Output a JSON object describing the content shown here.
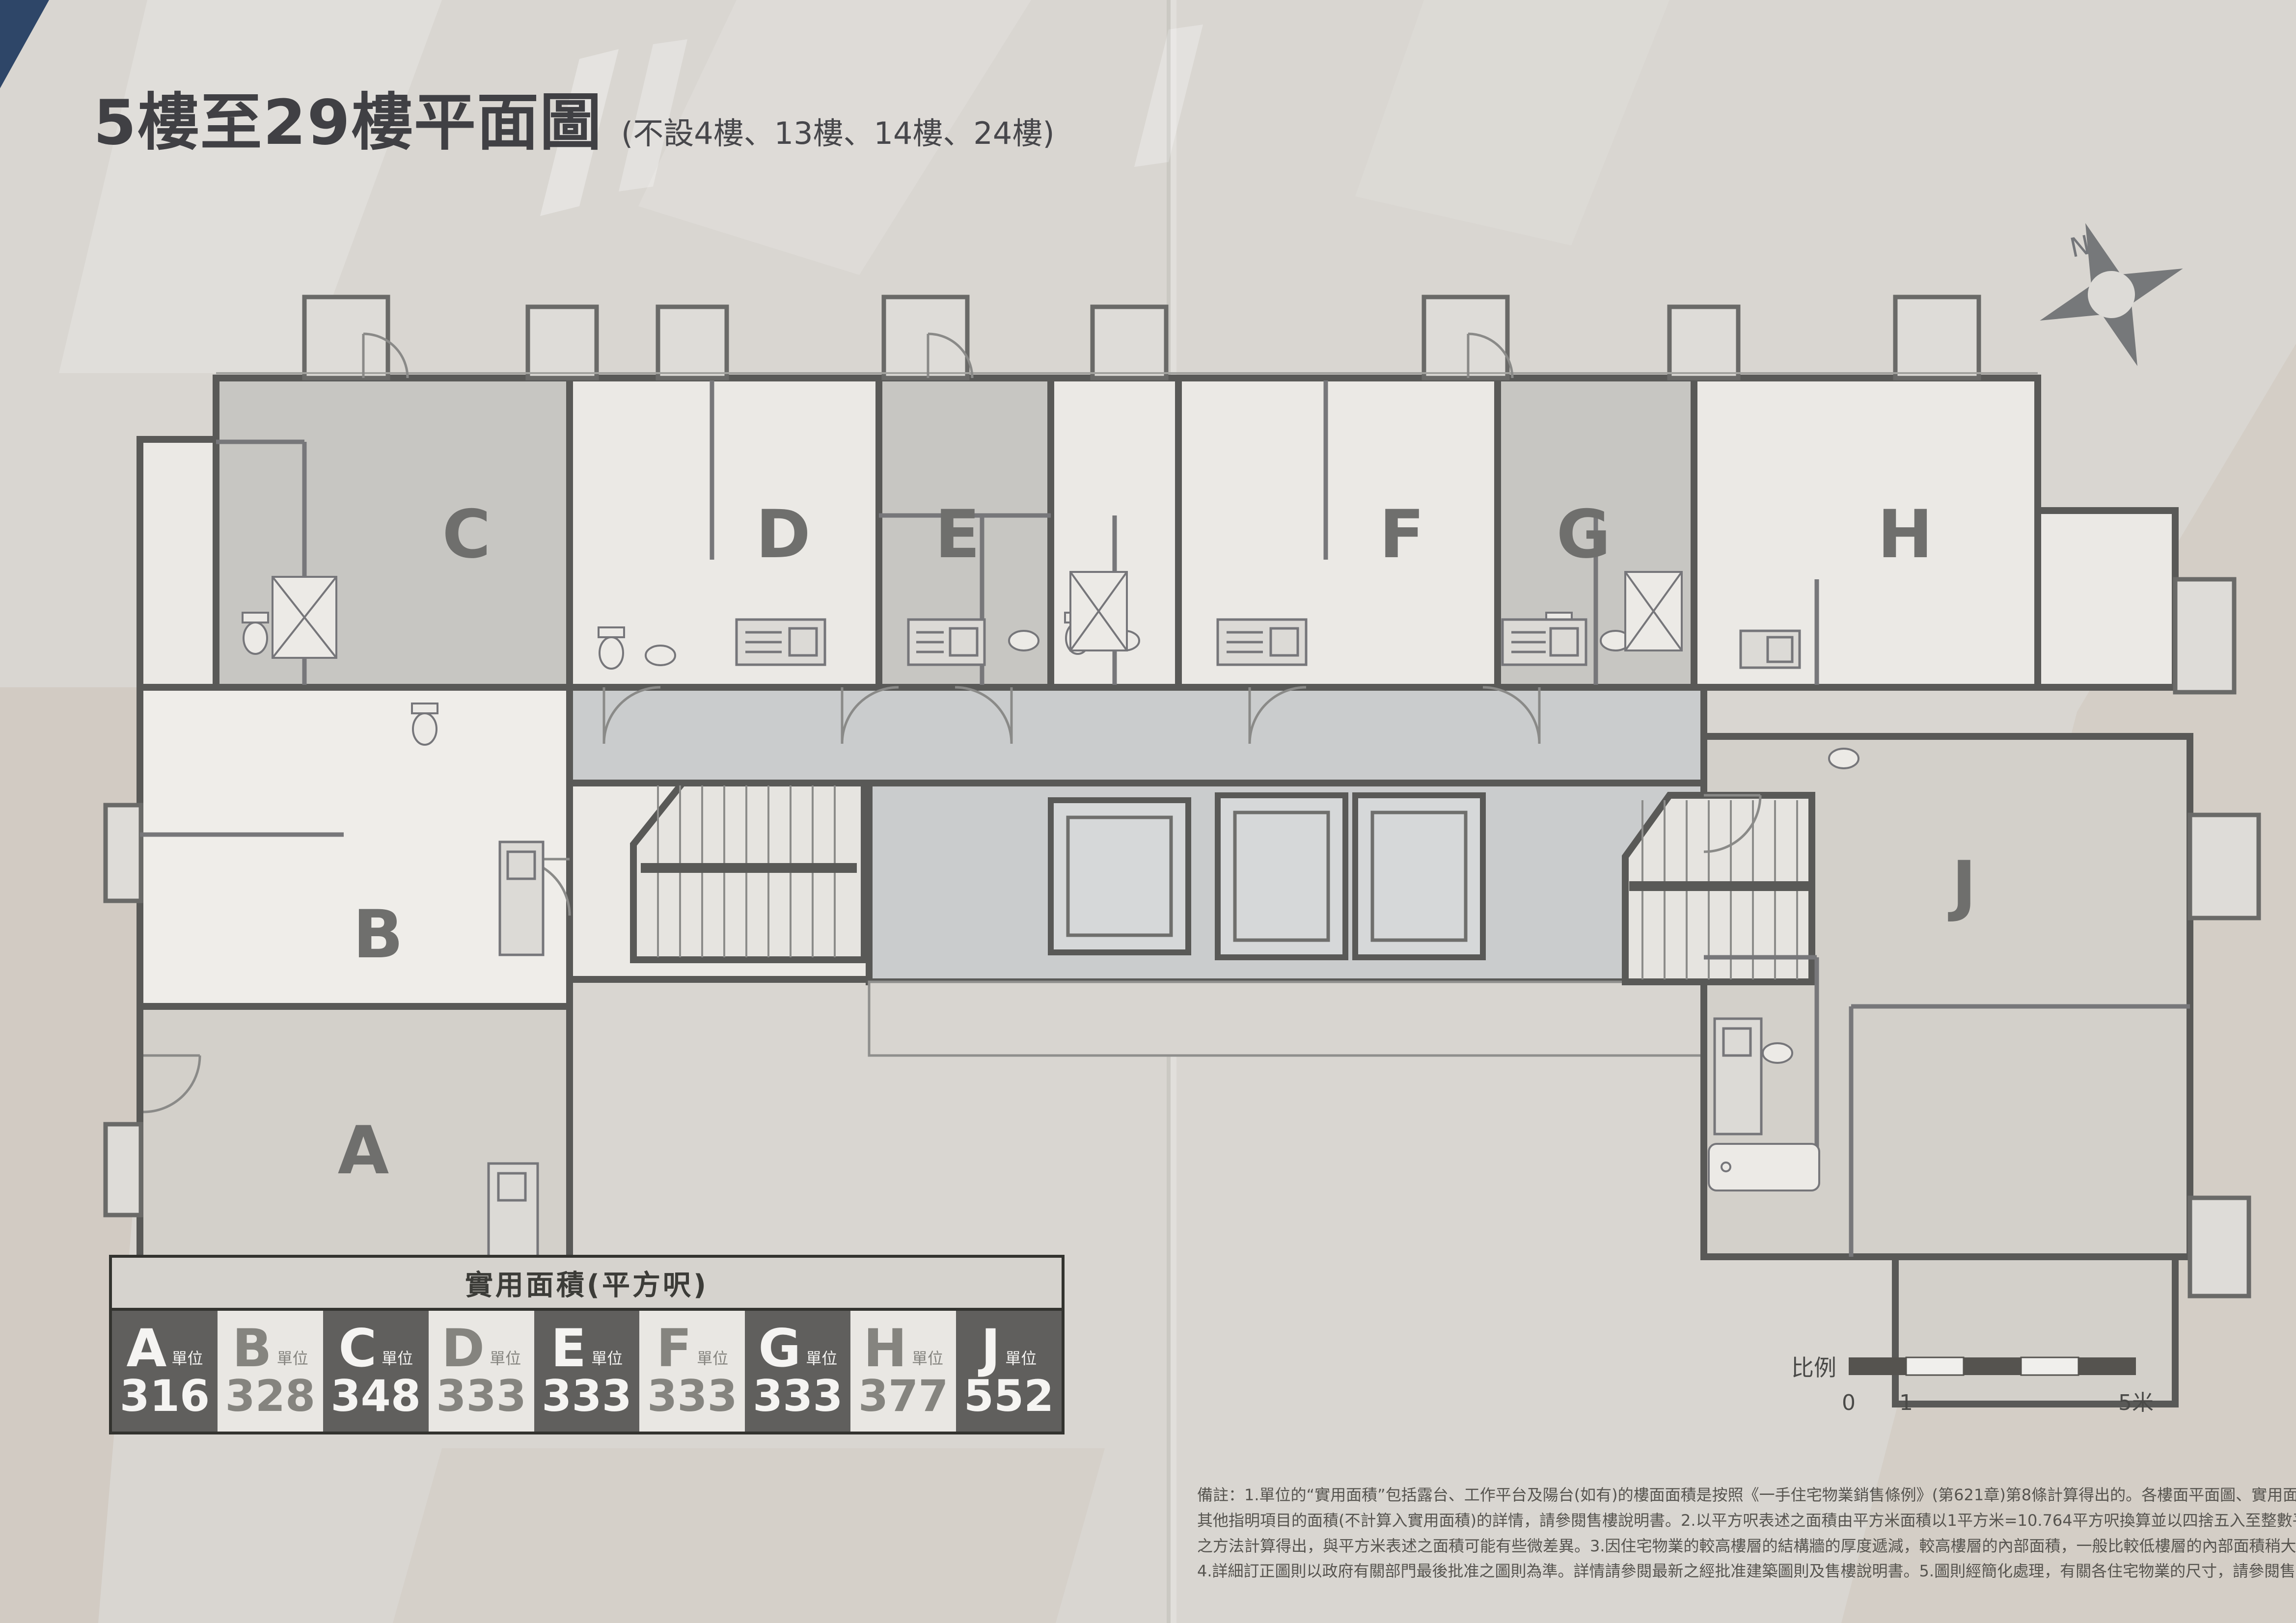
{
  "page": {
    "title": "5樓至29樓平面圖",
    "subtitle": "(不設4樓、13樓、14樓、24樓)"
  },
  "north": {
    "label": "N"
  },
  "plan": {
    "units": [
      {
        "letter": "A",
        "shade": "mid"
      },
      {
        "letter": "B",
        "shade": "white"
      },
      {
        "letter": "C",
        "shade": "dark"
      },
      {
        "letter": "D",
        "shade": "light"
      },
      {
        "letter": "E",
        "shade": "dark"
      },
      {
        "letter": "F",
        "shade": "light"
      },
      {
        "letter": "G",
        "shade": "dark"
      },
      {
        "letter": "H",
        "shade": "light"
      },
      {
        "letter": "J",
        "shade": "mid"
      }
    ]
  },
  "legend": {
    "header": "實用面積(平方呎)",
    "items": [
      {
        "letter": "A",
        "suffix": "單位",
        "area": "316",
        "variant": "dark"
      },
      {
        "letter": "B",
        "suffix": "單位",
        "area": "328",
        "variant": "light"
      },
      {
        "letter": "C",
        "suffix": "單位",
        "area": "348",
        "variant": "dark"
      },
      {
        "letter": "D",
        "suffix": "單位",
        "area": "333",
        "variant": "light"
      },
      {
        "letter": "E",
        "suffix": "單位",
        "area": "333",
        "variant": "dark"
      },
      {
        "letter": "F",
        "suffix": "單位",
        "area": "333",
        "variant": "light"
      },
      {
        "letter": "G",
        "suffix": "單位",
        "area": "333",
        "variant": "dark"
      },
      {
        "letter": "H",
        "suffix": "單位",
        "area": "377",
        "variant": "light"
      },
      {
        "letter": "J",
        "suffix": "單位",
        "area": "552",
        "variant": "dark"
      }
    ]
  },
  "scalebar": {
    "label": "比例",
    "ticks": [
      "0",
      "1",
      "5米"
    ]
  },
  "notes": {
    "lines": [
      "備註：1.單位的“實用面積”包括露台、工作平台及陽台(如有)的樓面面積是按照《一手住宅物業銷售條例》(第621章)第8條計算得出的。各樓面平面圖、實用面積及",
      "其他指明項目的面積(不計算入實用面積)的詳情，請參閱售樓說明書。2.以平方呎表述之面積由平方米面積以1平方米=10.764平方呎換算並以四捨五入至整數平方呎",
      "之方法計算得出，與平方米表述之面積可能有些微差異。3.因住宅物業的較高樓層的結構牆的厚度遞減，較高樓層的內部面積，一般比較低樓層的內部面積稍大。",
      "4.詳細訂正圖則以政府有關部門最後批准之圖則為準。詳情請參閱最新之經批准建築圖則及售樓說明書。5.圖則經簡化處理，有關各住宅物業的尺寸，請參閱售樓說明書。"
    ]
  },
  "colors": {
    "page_bg": "#d9d6d1",
    "wall": "#595957",
    "unit_dark": "#c7c6c2",
    "unit_light": "#ebe9e5",
    "unit_mid": "#d3d0ca",
    "corridor": "#cacccd",
    "legend_dark_cell": "#605f5d",
    "legend_light_cell": "#e9e7e3",
    "title_text": "#404044"
  }
}
